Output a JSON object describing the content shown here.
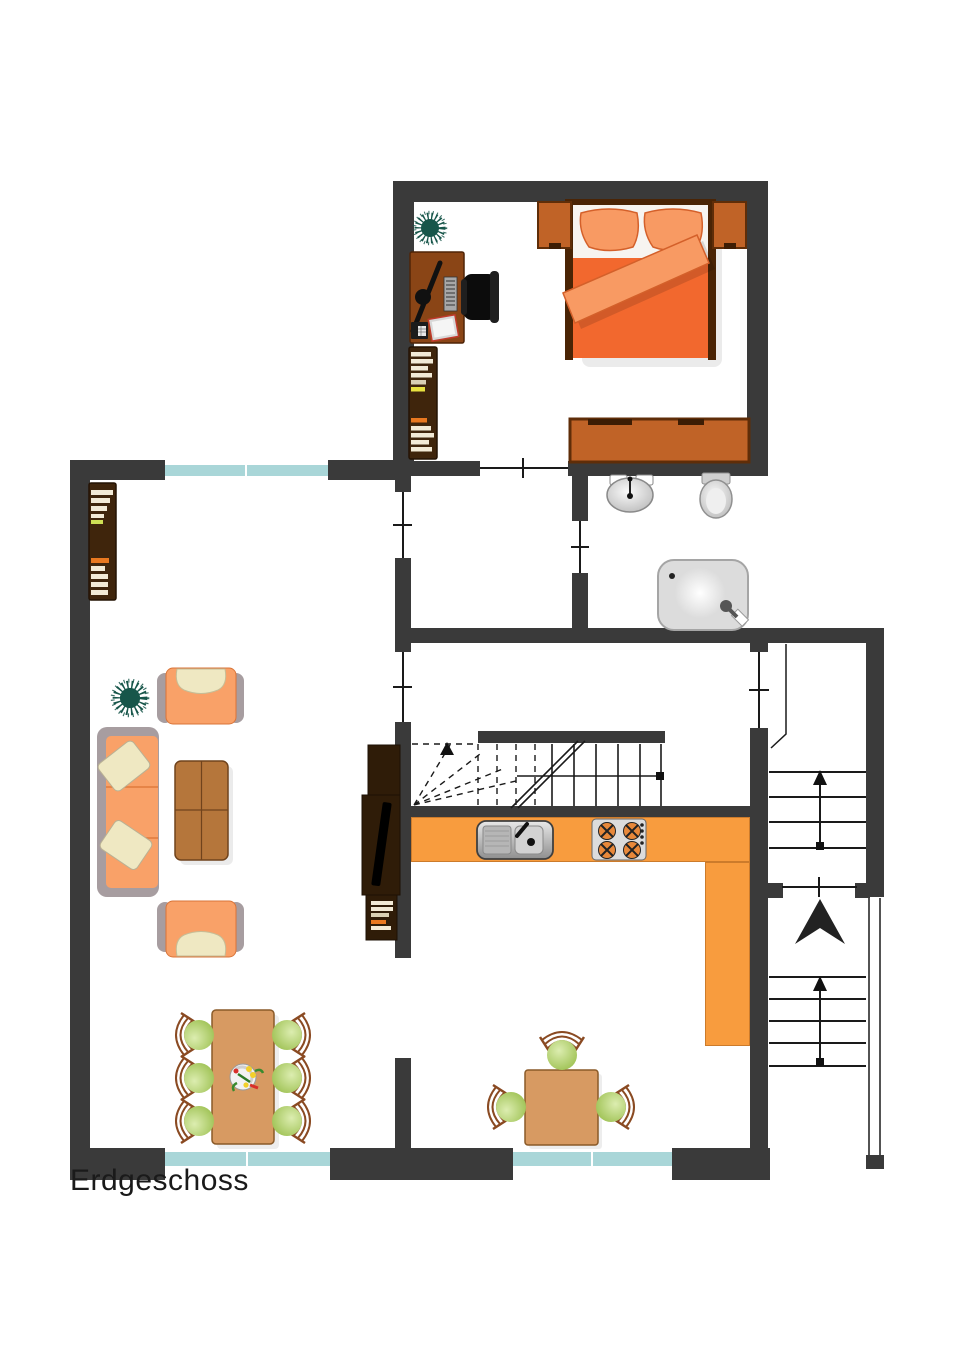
{
  "floor": {
    "label": "Erdgeschoss"
  },
  "colors": {
    "bg": "#ffffff",
    "wall": "#3a3a3a",
    "line": "#1a1a1a",
    "text": "#1a1a1a",
    "window": "#a9d6d8",
    "counter": "#f89c3e",
    "bedframe": "#4a2405",
    "mattress": "#f7f4f0",
    "duvet": "#f2682e",
    "pillow": "#f89a63",
    "nightstand": "#c06327",
    "trim": "#5f2d08",
    "deskWood": "#8a4516",
    "shelfWood": "#3f250c",
    "tvWood": "#2f1c08",
    "coffeeTable": "#b5763b",
    "tableWood": "#d79a62",
    "upholstery": "#f9a168",
    "upholsteryEdge": "#d97438",
    "frameGray": "#a79da0",
    "cushion": "#efe8c2",
    "seatGreen": "#9cc050",
    "chairFrame": "#8a4a22",
    "plantGreen": "#17564a",
    "book": "#f2ead6",
    "bookYellow": "#e8e240",
    "bookOrange": "#e87820",
    "fixtureGray": "#cfcfcf"
  },
  "furniture_icons": [
    "double-bed",
    "pillow",
    "blanket",
    "nightstand",
    "dresser",
    "desk",
    "desk-lamp",
    "keyboard",
    "telephone",
    "notepad",
    "office-chair",
    "bookshelf",
    "potted-plant",
    "bathroom-sink",
    "toilet",
    "shower",
    "sofa",
    "sofa-pillow",
    "armchair",
    "coffee-table",
    "tv-cabinet",
    "tv-screen",
    "kitchen-counter",
    "kitchen-sink",
    "stove",
    "staircase",
    "stair-arrow",
    "entrance-arrow",
    "dining-table",
    "dining-chair",
    "flower-vase",
    "kitchen-table",
    "door-swing",
    "window"
  ]
}
